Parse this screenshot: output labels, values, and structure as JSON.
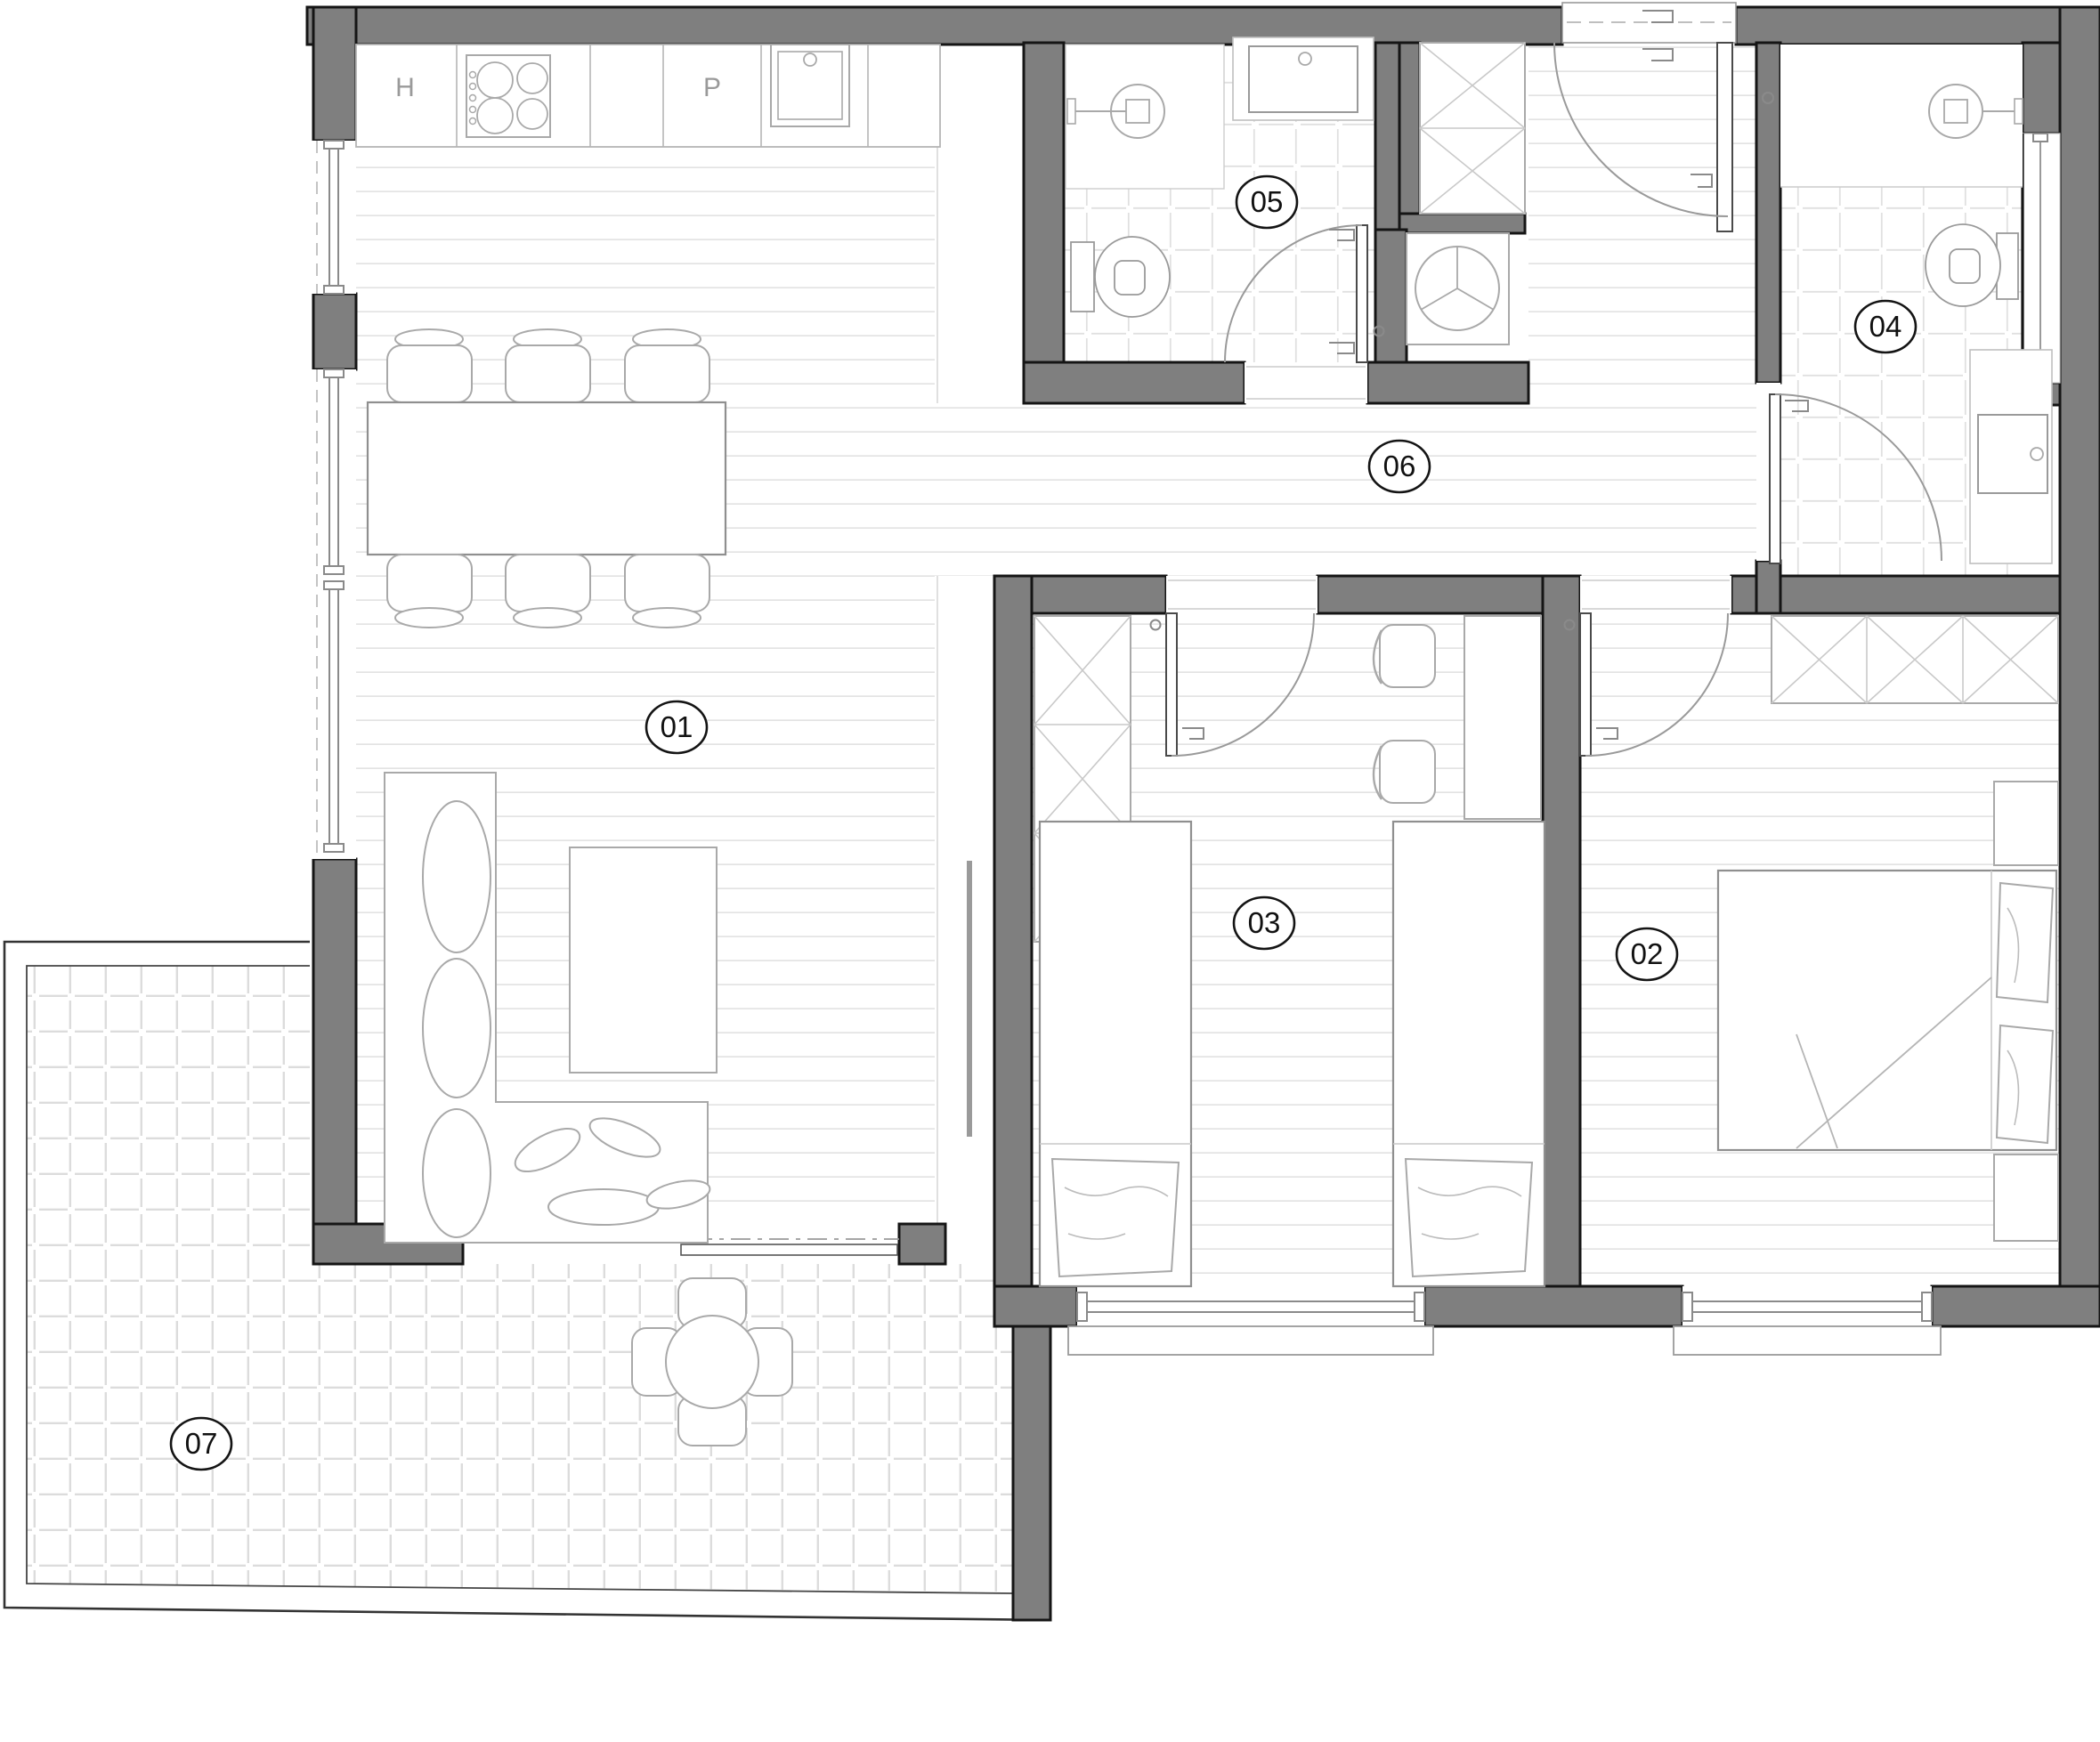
{
  "rooms": [
    {
      "id": "room-01",
      "label": "01"
    },
    {
      "id": "room-02",
      "label": "02"
    },
    {
      "id": "room-03",
      "label": "03"
    },
    {
      "id": "room-04",
      "label": "04"
    },
    {
      "id": "room-05",
      "label": "05"
    },
    {
      "id": "room-06",
      "label": "06"
    },
    {
      "id": "room-07",
      "label": "07"
    }
  ],
  "kitchen": {
    "labels": [
      {
        "text": "H"
      },
      {
        "text": "P"
      }
    ]
  },
  "colors": {
    "wall_fill": "#7f7f7f",
    "wall_outline": "#151515",
    "fixture_line": "#a9a9a9",
    "floor_plank_line": "#e3e3e3",
    "bath_tile_line": "#e0e0e0",
    "terrace_tile_line": "#dcdcdc",
    "label_text": "#111111"
  }
}
